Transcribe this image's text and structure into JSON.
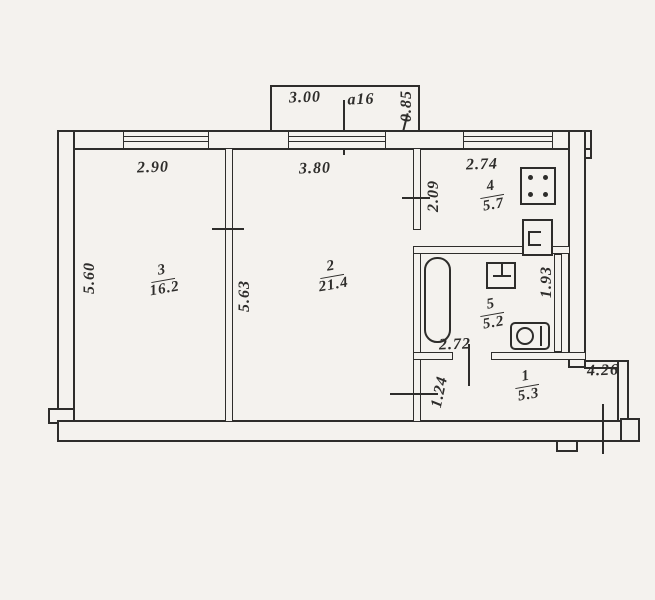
{
  "plan": {
    "title": "apartment-floor-plan",
    "balcony": {
      "width": "3.00",
      "code": "a16",
      "depth": "0.85"
    },
    "rooms": [
      {
        "key": "room-3",
        "number": "3",
        "area": "16.2"
      },
      {
        "key": "room-2",
        "number": "2",
        "area": "21.4"
      },
      {
        "key": "kitchen",
        "number": "4",
        "area": "5.7"
      },
      {
        "key": "bathroom",
        "number": "5",
        "area": "5.2"
      },
      {
        "key": "hallway",
        "number": "1",
        "area": "5.3"
      }
    ],
    "dimensions": {
      "room3_width": "2.90",
      "room2_width": "3.80",
      "kitchen_width": "2.74",
      "kitchen_depth": "2.09",
      "left_wall_depth": "5.60",
      "room2_depth": "5.63",
      "bathroom_right_depth": "1.93",
      "bathroom_width": "2.72",
      "hallway_depth": "1.24",
      "hallway_width": "4.26"
    },
    "fixtures": [
      "stove",
      "kitchen-sink",
      "bathtub",
      "washbasin",
      "toilet"
    ],
    "colors": {
      "line": "#2e2d2b",
      "paper": "#f4f2ee"
    }
  }
}
